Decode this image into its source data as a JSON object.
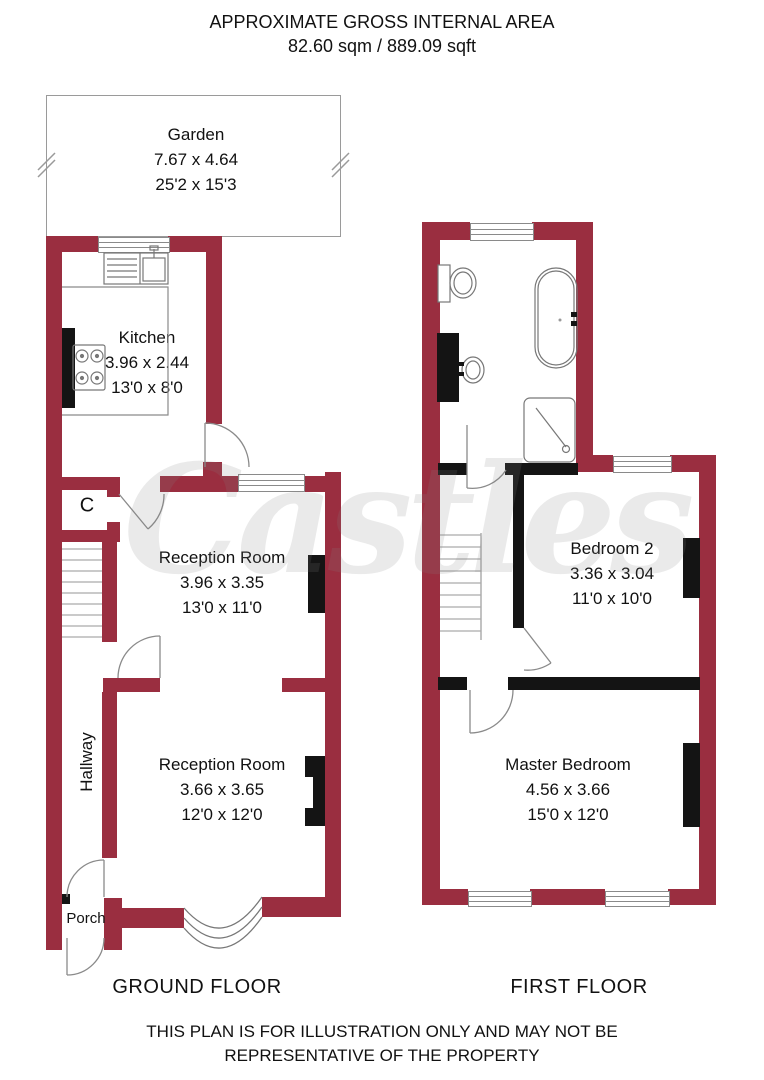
{
  "header": {
    "line1": "APPROXIMATE GROSS INTERNAL AREA",
    "line2": "82.60 sqm / 889.09 sqft"
  },
  "watermark": "Castles",
  "ground_floor": {
    "title": "GROUND FLOOR",
    "garden": {
      "name": "Garden",
      "metric": "7.67 x 4.64",
      "imperial": "25'2 x 15'3"
    },
    "kitchen": {
      "name": "Kitchen",
      "metric": "3.96 x 2.44",
      "imperial": "13'0 x 8'0"
    },
    "reception_room_1": {
      "name": "Reception Room",
      "metric": "3.96 x 3.35",
      "imperial": "13'0 x 11'0"
    },
    "reception_room_2": {
      "name": "Reception Room",
      "metric": "3.66 x 3.65",
      "imperial": "12'0 x 12'0"
    },
    "hallway": {
      "name": "Hallway"
    },
    "porch": {
      "name": "Porch"
    },
    "cupboard": {
      "name": "C"
    }
  },
  "first_floor": {
    "title": "FIRST FLOOR",
    "bedroom_2": {
      "name": "Bedroom 2",
      "metric": "3.36 x 3.04",
      "imperial": "11'0 x 10'0"
    },
    "master_bedroom": {
      "name": "Master Bedroom",
      "metric": "4.56 x 3.66",
      "imperial": "15'0 x 12'0"
    }
  },
  "footer": {
    "line1": "THIS PLAN IS FOR ILLUSTRATION ONLY AND MAY NOT BE",
    "line2": "REPRESENTATIVE OF THE PROPERTY"
  },
  "colors": {
    "wall": "#9a2e40",
    "partition": "#141414",
    "outline": "#8a8a8a",
    "text": "#111111"
  }
}
